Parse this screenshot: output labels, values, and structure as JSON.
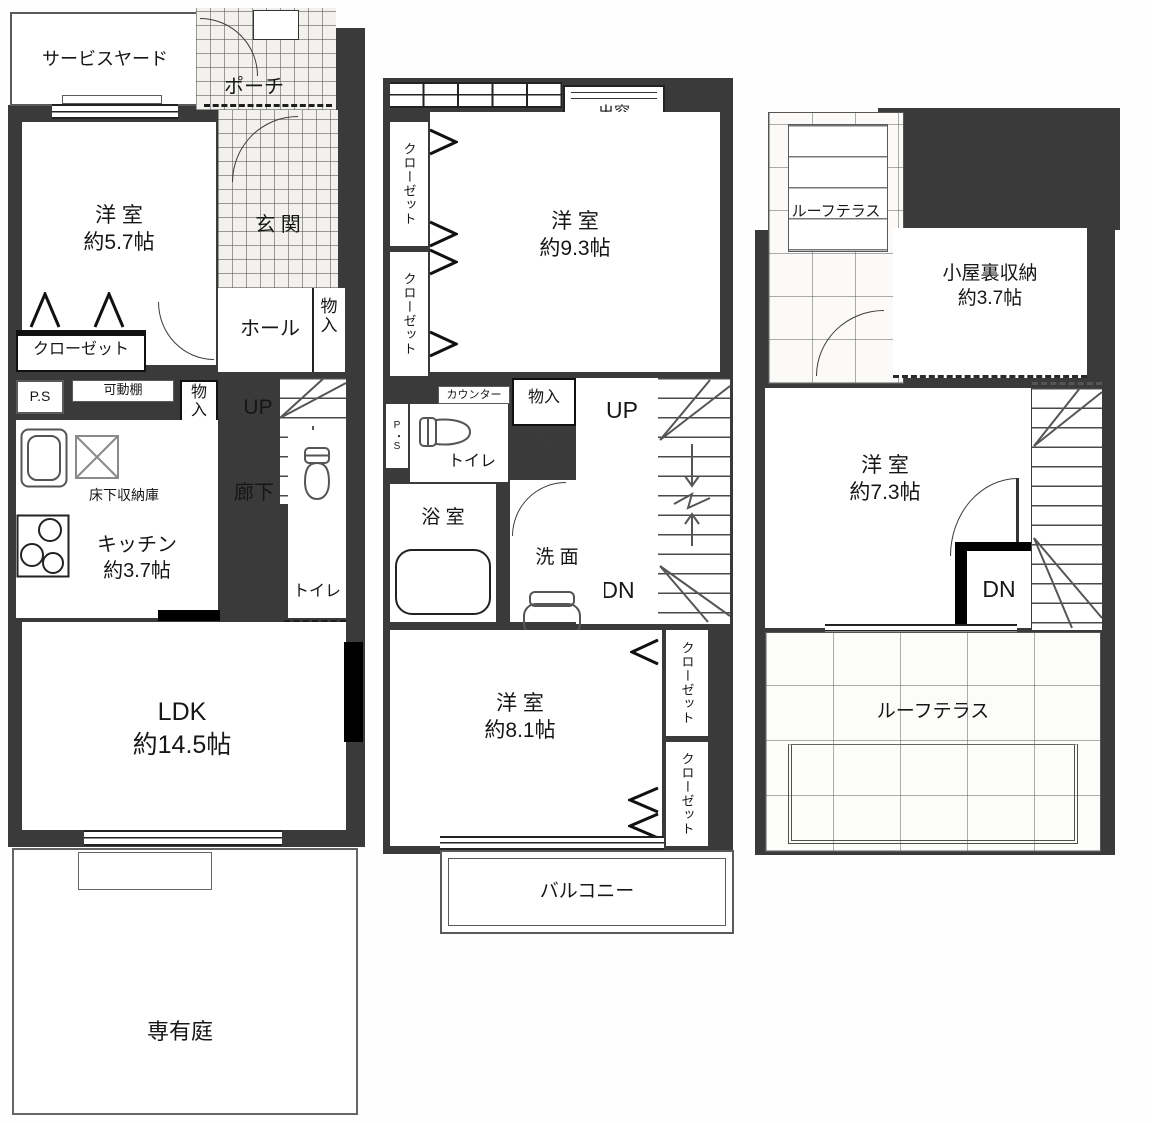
{
  "f1": {
    "service_yard": "サービスヤード",
    "porch": "ポーチ",
    "room_name": "洋 室",
    "room_size": "約5.7帖",
    "genkan": "玄 関",
    "hall": "ホール",
    "closet": "クローゼット",
    "storage": "物入",
    "ps": "P.S",
    "movable_shelf": "可動棚",
    "up": "UP",
    "underfloor": "床下収納庫",
    "kitchen": "キッチン",
    "kitchen_size": "約3.7帖",
    "corridor": "廊下",
    "toilet": "トイレ",
    "ldk": "LDK",
    "ldk_size": "約14.5帖",
    "garden": "専有庭"
  },
  "f2": {
    "closet": "クローゼット",
    "bay_window": "出窓",
    "room_name": "洋 室",
    "room_size": "約9.3帖",
    "counter": "カウンター",
    "ps": "P・S",
    "toilet": "トイレ",
    "storage": "物入",
    "up": "UP",
    "dn": "DN",
    "bath": "浴 室",
    "washroom": "洗 面",
    "room2_name": "洋 室",
    "room2_size": "約8.1帖",
    "balcony": "バルコニー"
  },
  "f3": {
    "roof_terrace": "ルーフテラス",
    "attic": "小屋裏収納",
    "attic_size": "約3.7帖",
    "room_name": "洋 室",
    "room_size": "約7.3帖",
    "dn": "DN",
    "roof_terrace2": "ルーフテラス"
  },
  "colors": {
    "wall": "#3a3a3a",
    "line": "#3c3c3c",
    "tile_line": "#777777"
  }
}
